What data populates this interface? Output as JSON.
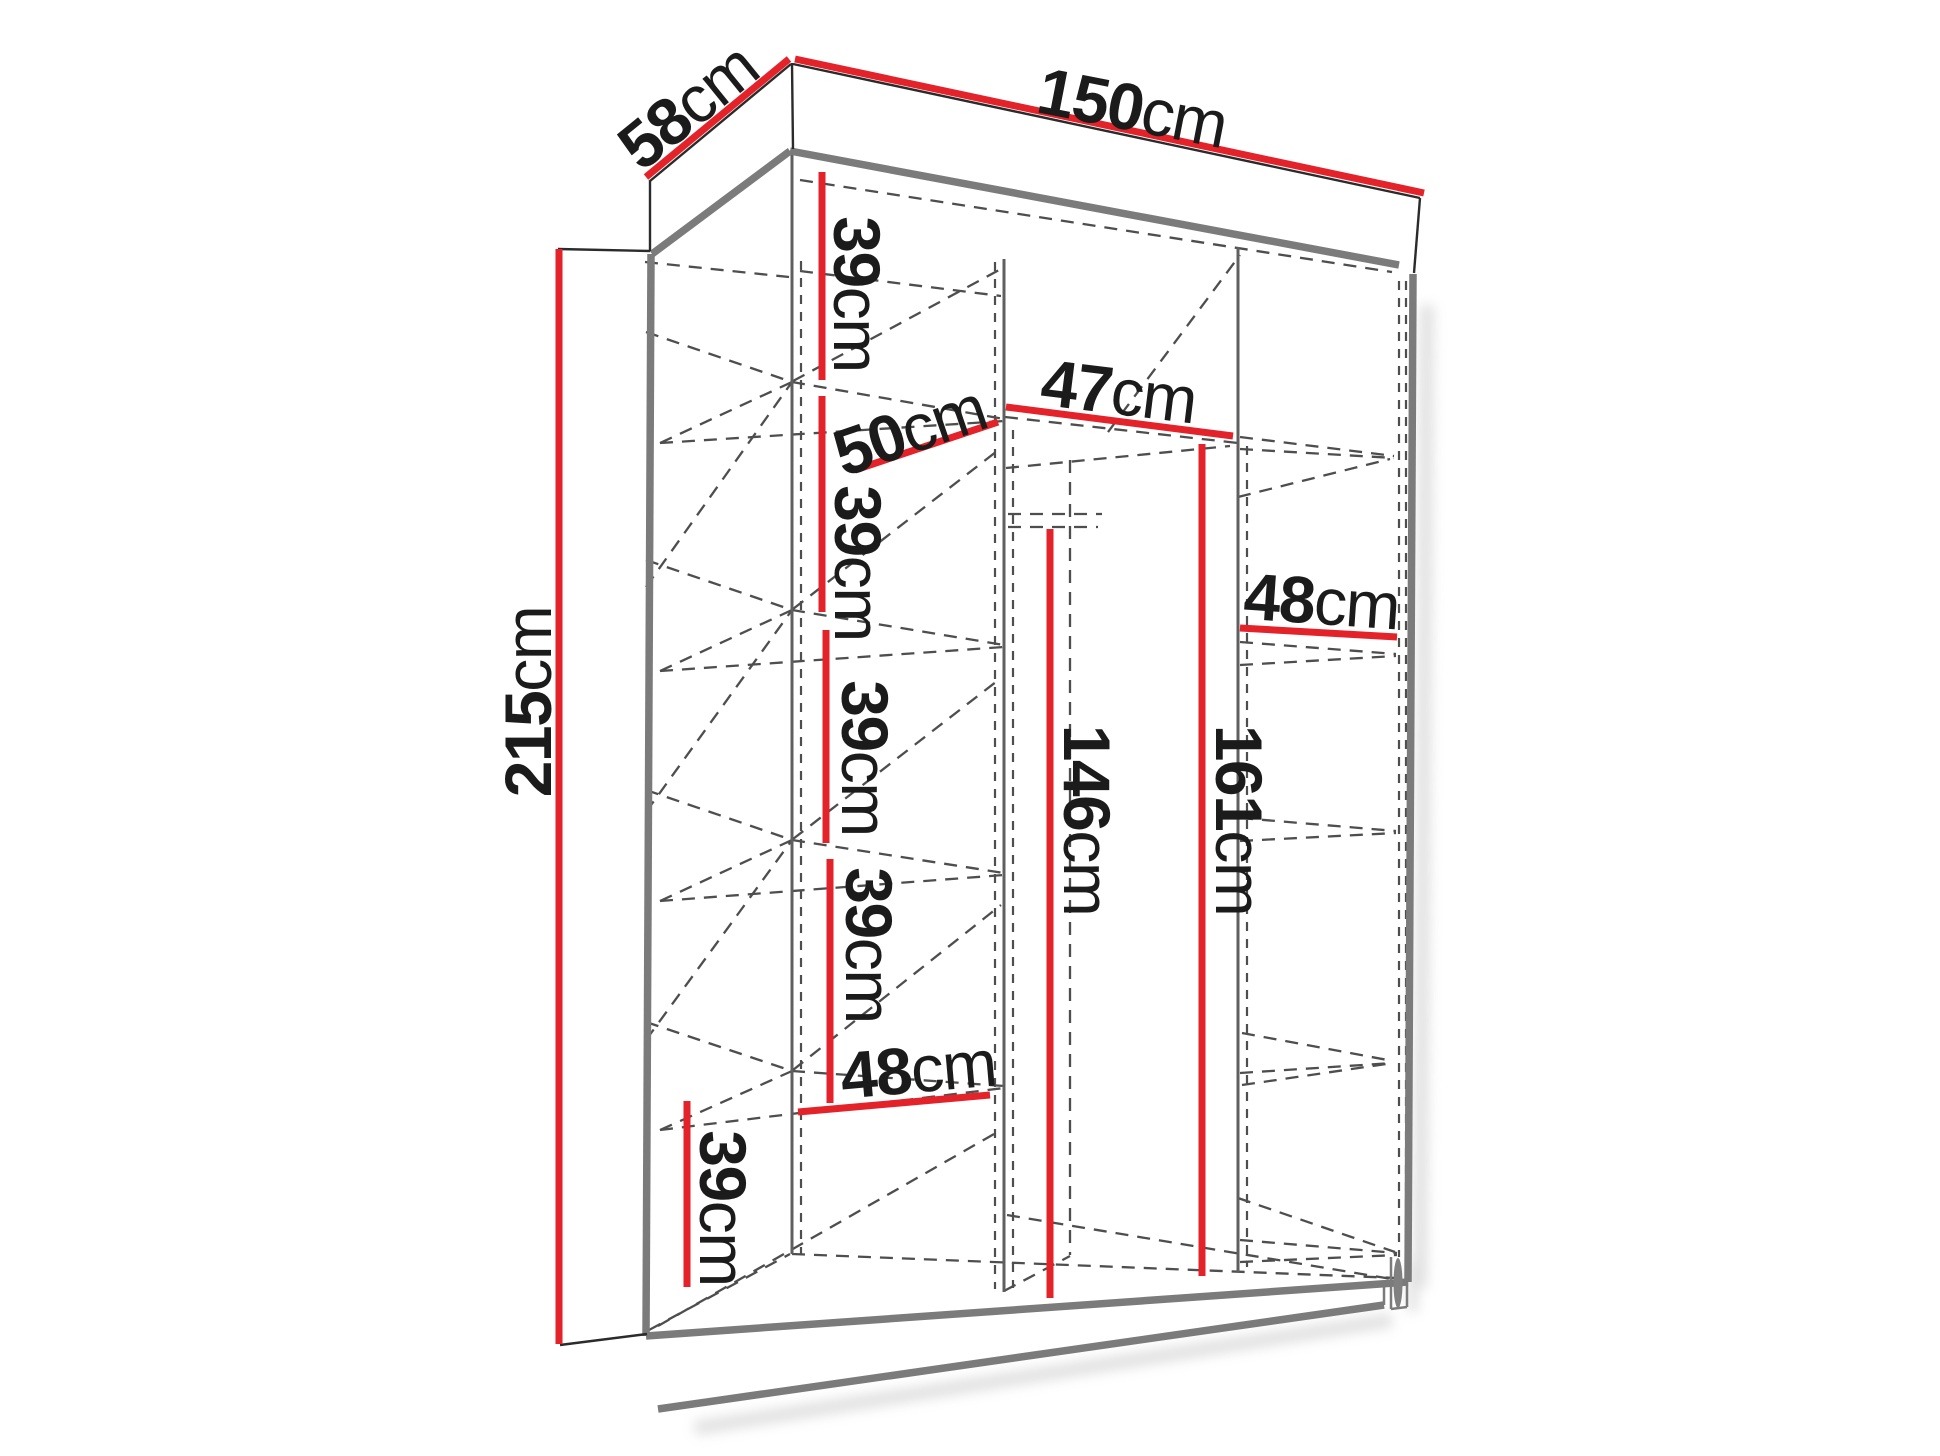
{
  "diagram": {
    "type": "furniture-dimension-diagram",
    "subject": "wardrobe with interior shelves and hanging space",
    "unit": "cm",
    "overall": {
      "width_cm": 150,
      "depth_cm": 58,
      "height_cm": 215
    },
    "labels": {
      "width": {
        "value": "150",
        "unit": "cm"
      },
      "depth": {
        "value": "58",
        "unit": "cm"
      },
      "height": {
        "value": "215",
        "unit": "cm"
      },
      "shelf_gap_1": {
        "value": "39",
        "unit": "cm"
      },
      "shelf_gap_2": {
        "value": "39",
        "unit": "cm"
      },
      "shelf_gap_3": {
        "value": "39",
        "unit": "cm"
      },
      "shelf_gap_4": {
        "value": "39",
        "unit": "cm"
      },
      "shelf_gap_bottom": {
        "value": "39",
        "unit": "cm"
      },
      "shelf_depth": {
        "value": "50",
        "unit": "cm"
      },
      "middle_width": {
        "value": "47",
        "unit": "cm"
      },
      "right_width": {
        "value": "48",
        "unit": "cm"
      },
      "left_width": {
        "value": "48",
        "unit": "cm"
      },
      "hanging_height": {
        "value": "146",
        "unit": "cm"
      },
      "open_height": {
        "value": "161",
        "unit": "cm"
      }
    },
    "colors": {
      "dimension_line": "#e3222a",
      "outline": "#2b2b2b",
      "frame": "#7b7b7b",
      "hidden_line": "#4e4e4e",
      "background": "#ffffff",
      "text": "#1b1b1b"
    }
  }
}
